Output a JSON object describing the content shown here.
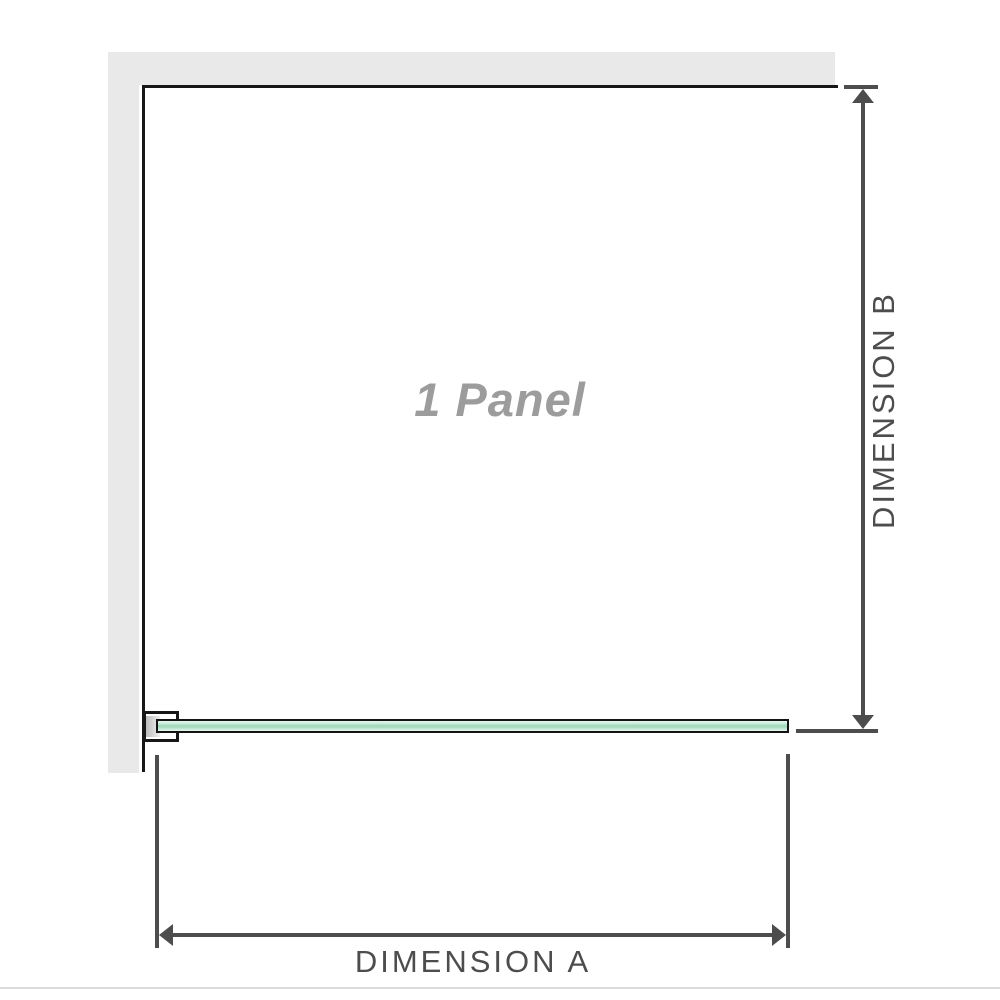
{
  "diagram": {
    "panel_label": "1 Panel",
    "dimensions": {
      "horizontal_label": "DIMENSION A",
      "vertical_label": "DIMENSION B"
    }
  },
  "colors": {
    "wall": "#e9e9e9",
    "frame": "#171717",
    "dimension": "#4d4d4d",
    "panel_text": "#9c9c9c",
    "glass_border": "#141414",
    "glass_light": "#e3f5ec",
    "glass_mid": "#9fd8ba",
    "bracket_pad": "#bdbdbd",
    "divider": "#dbdbdb"
  }
}
